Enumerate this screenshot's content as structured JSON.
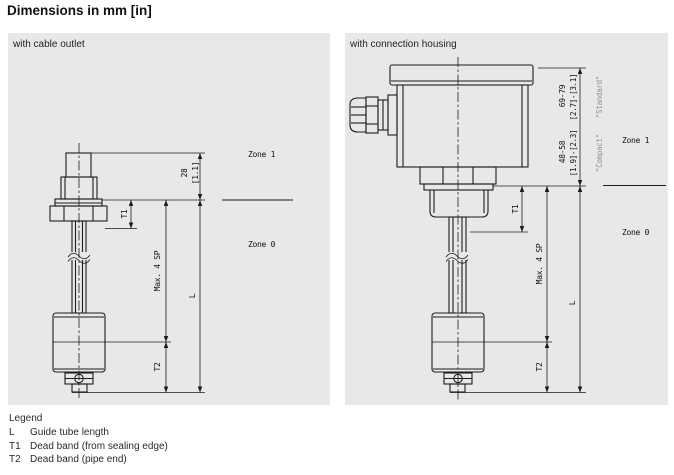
{
  "page": {
    "title": "Dimensions in mm [in]"
  },
  "panels": {
    "left": {
      "title": "with cable outlet",
      "labels": {
        "dim_28": "28",
        "dim_28_in": "[1.1]",
        "t1": "T1",
        "max_sp": "Max. 4 SP",
        "t2": "T2",
        "l": "L",
        "zone1": "Zone 1",
        "zone0": "Zone 0"
      }
    },
    "right": {
      "title": "with connection housing",
      "labels": {
        "standard_mm": "69-79",
        "standard_in": "[2.7]-[3.1]",
        "standard_name": "\"Standard\"",
        "compact_mm": "48-58",
        "compact_in": "[1.9]-[2.3]",
        "compact_name": "\"Compact\"",
        "t1": "T1",
        "max_sp": "Max. 4 SP",
        "t2": "T2",
        "l": "L",
        "zone1": "Zone 1",
        "zone0": "Zone 0"
      }
    }
  },
  "legend": {
    "title": "Legend",
    "items": [
      {
        "term": "L",
        "desc": "Guide tube length"
      },
      {
        "term": "T1",
        "desc": "Dead band (from sealing edge)"
      },
      {
        "term": "T2",
        "desc": "Dead band (pipe end)"
      }
    ]
  },
  "colors": {
    "panel_bg": "#e8e8e8",
    "line": "#1c1c1c",
    "muted_label": "#8f8f9c"
  }
}
